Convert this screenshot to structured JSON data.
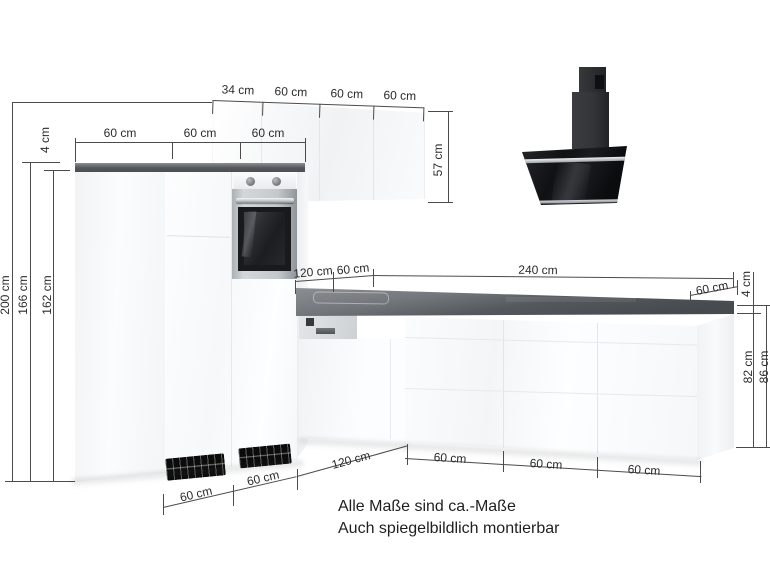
{
  "scene": {
    "type": "kitchen-dimension-diagram",
    "colors": {
      "worktop": "#55595d",
      "cabinet": "#fafbfc",
      "hood": "#141518",
      "dimension_lines": "#4b4b4b",
      "text": "#2b2b2b"
    }
  },
  "dims": {
    "upper_cabinets_top": [
      "34 cm",
      "60 cm",
      "60 cm",
      "60 cm"
    ],
    "left_worktop": [
      "60 cm",
      "60 cm",
      "60 cm"
    ],
    "left_heights": {
      "worktop_thickness": "4 cm",
      "total": "200 cm",
      "to_worktop_top": "166 cm",
      "to_worktop_bottom": "162 cm"
    },
    "upper_cabinet_height": "57 cm",
    "mid": {
      "a": "120 cm",
      "b": "60 cm",
      "c": "240 cm"
    },
    "right": {
      "depth": "60 cm",
      "worktop_thickness": "4 cm",
      "base_height": "82 cm",
      "total_height": "86 cm"
    },
    "bottom": {
      "left": [
        "60 cm",
        "60 cm"
      ],
      "mid": "120 cm",
      "right": [
        "60 cm",
        "60 cm",
        "60 cm"
      ]
    }
  },
  "caption": {
    "line1": "Alle Maße sind ca.-Maße",
    "line2": "Auch spiegelbildlich montierbar"
  }
}
